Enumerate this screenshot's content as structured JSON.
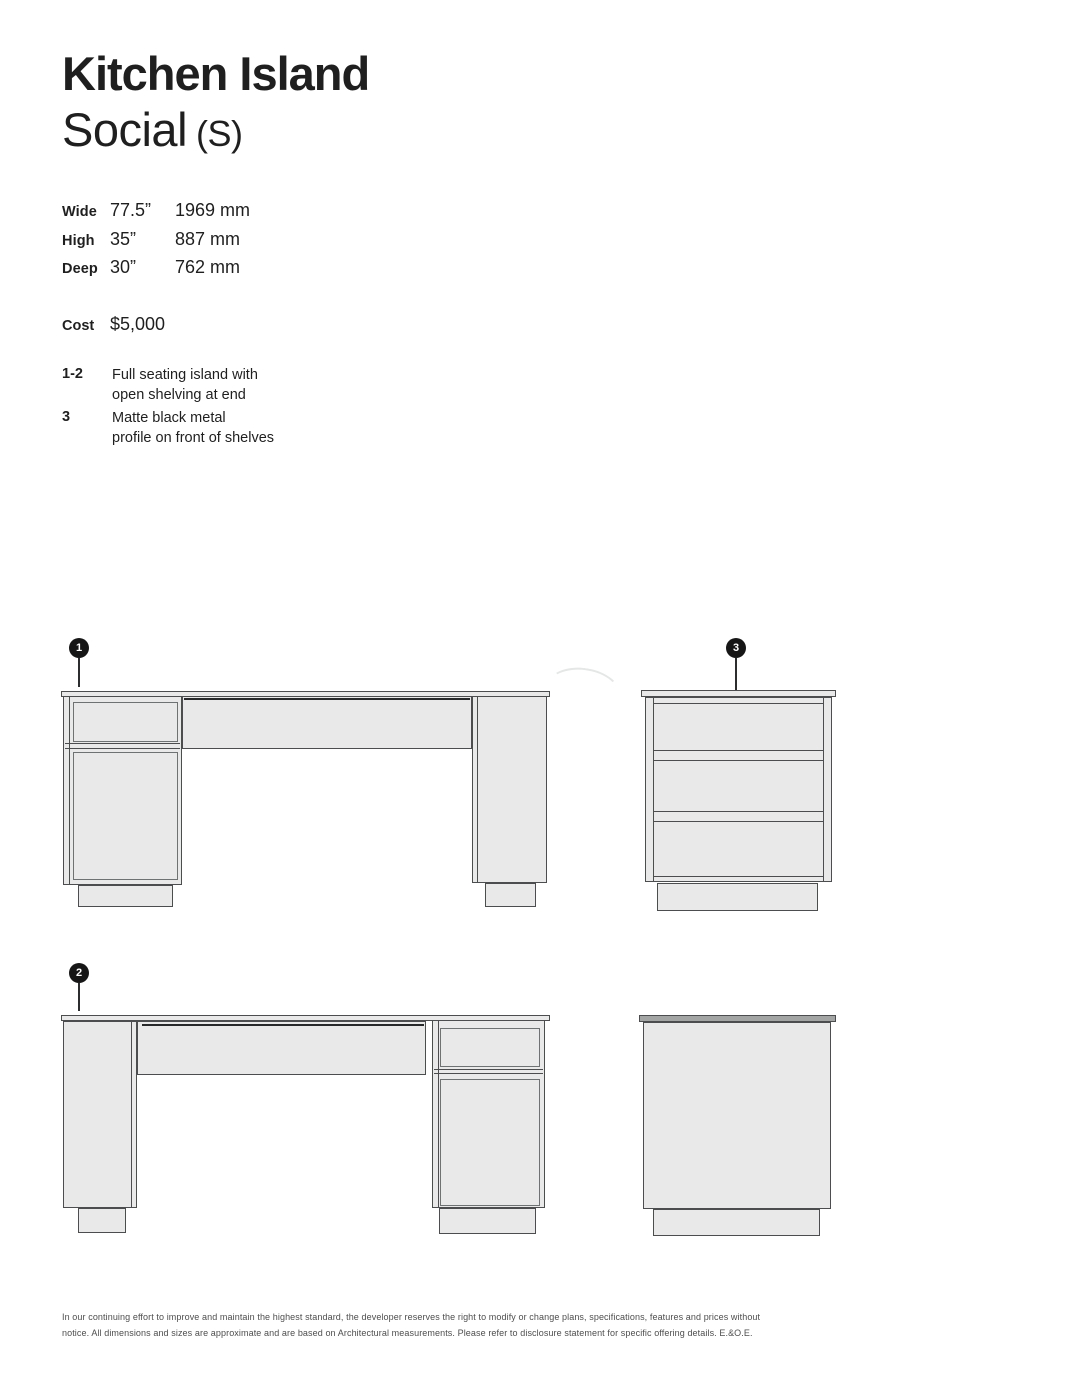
{
  "header": {
    "title": "Kitchen Island",
    "subtitle": "Social",
    "size_code": "(S)"
  },
  "specs": {
    "rows": [
      {
        "label": "Wide",
        "imperial": "77.5”",
        "metric": "1969 mm"
      },
      {
        "label": "High",
        "imperial": "35”",
        "metric": "887 mm"
      },
      {
        "label": "Deep",
        "imperial": "30”",
        "metric": "762 mm"
      }
    ],
    "cost_label": "Cost",
    "cost_value": "$5,000"
  },
  "notes": [
    {
      "key": "1-2",
      "text": "Full seating island with\nopen shelving at end"
    },
    {
      "key": "3",
      "text": "Matte black metal\nprofile on front of shelves"
    }
  ],
  "callouts": {
    "c1": "1",
    "c2": "2",
    "c3": "3"
  },
  "watermark": "hinabian",
  "footer": {
    "text": "In our continuing effort to improve and maintain the highest standard, the developer reserves the right to modify or change plans, specifications, features and prices without\nnotice. All dimensions and sizes are approximate and are based on Architectural measurements. Please refer to disclosure statement for specific offering details. E.&O.E."
  },
  "colors": {
    "ink": "#1f1f1f",
    "line": "#4b4d4e",
    "line_soft": "#6f7273",
    "fill": "#e8e9e8",
    "counter_dark": "#a2a5a4"
  }
}
